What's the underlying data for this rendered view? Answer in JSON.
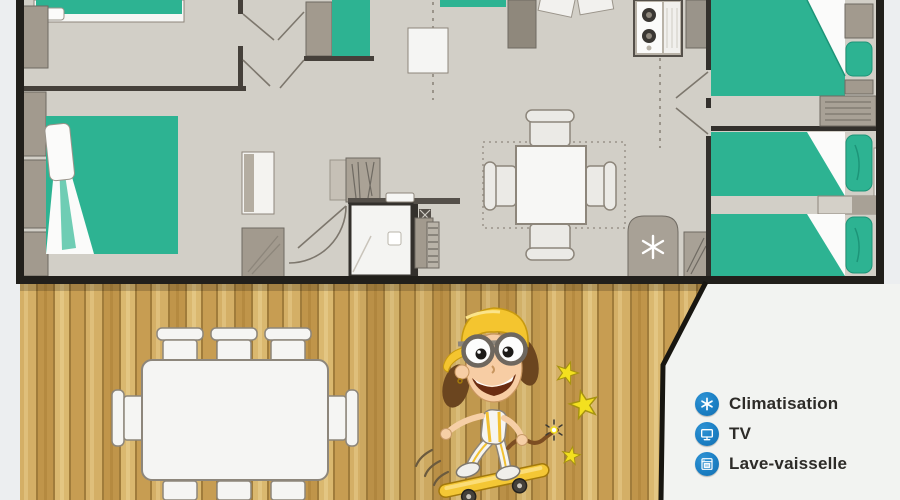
{
  "legend": {
    "items": [
      {
        "icon": "air-conditioning-icon",
        "label": "Climatisation"
      },
      {
        "icon": "tv-icon",
        "label": "TV"
      },
      {
        "icon": "dishwasher-icon",
        "label": "Lave-vaisselle"
      }
    ]
  },
  "colors": {
    "legend_icon_blue": "#1b7fc4",
    "legend_text": "#2d2b28",
    "bed_teal": "#2db392",
    "floor_gray": "#d2cfc7",
    "wall_dark": "#211f1b",
    "furniture_gray": "#a29a8e",
    "deck_wood_tan": "#c9a258",
    "mascot_yellow": "#f4c52f",
    "panel_white": "#f2f3f1"
  }
}
